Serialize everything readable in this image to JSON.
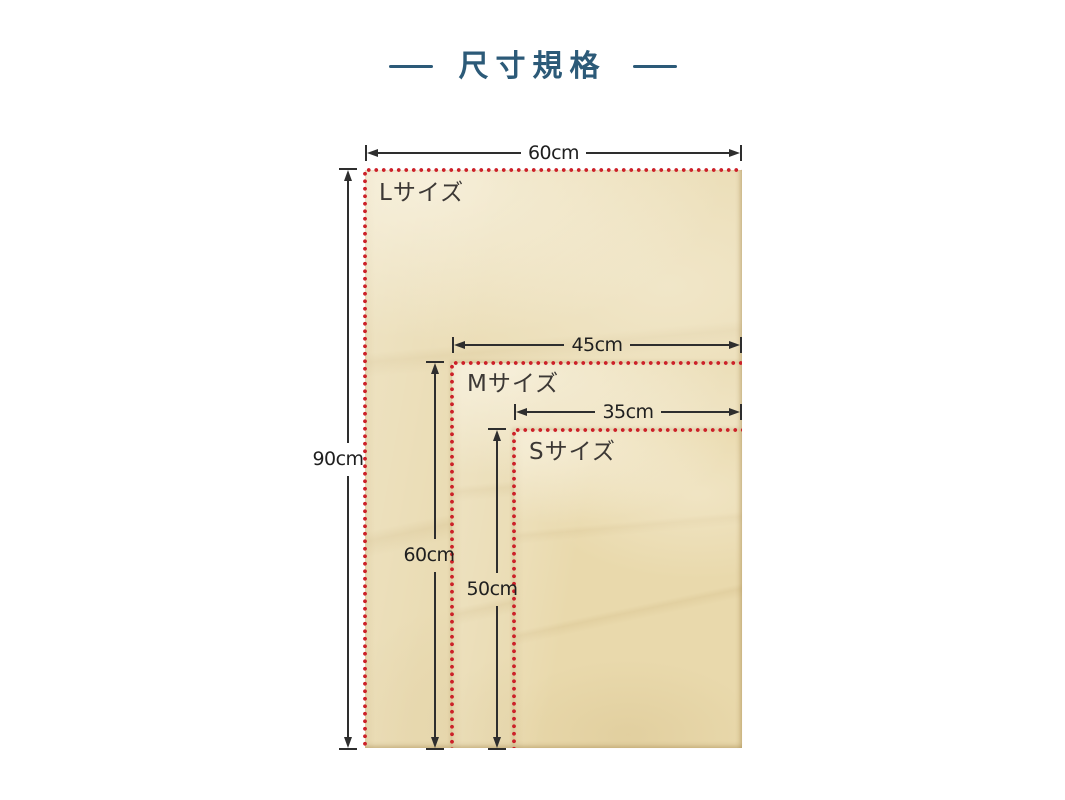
{
  "title": {
    "text": "尺寸規格"
  },
  "palette": {
    "title_color": "#2c5a78",
    "dot_color": "#cc2129",
    "paper_color": "#eadcb4",
    "ink_color": "#2e2e2e"
  },
  "diagram": {
    "unit": "cm",
    "sizes": [
      {
        "id": "L",
        "label": "Lサイズ",
        "width": "60cm",
        "height": "90cm"
      },
      {
        "id": "M",
        "label": "Mサイズ",
        "width": "45cm",
        "height": "60cm"
      },
      {
        "id": "S",
        "label": "Sサイズ",
        "width": "35cm",
        "height": "50cm"
      }
    ]
  }
}
